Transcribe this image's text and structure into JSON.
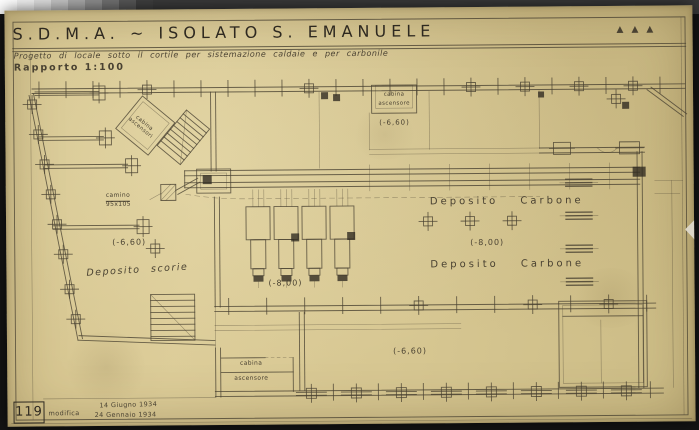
{
  "photo": {
    "background": "#141414",
    "top_strip": "#3a3a3a",
    "calibration_patches": [
      "#ffffff",
      "#f1f1f1",
      "#dedede",
      "#c4c4c4",
      "#a8a8a8",
      "#8d8d8d",
      "#717171",
      "#575757",
      "#3f3f3f"
    ]
  },
  "palette": {
    "photo-bg": "#141414",
    "strip-bg": "#3a3a3a",
    "paper": "#d8c894",
    "ink": "#4a4232",
    "ink-dark": "#2e2920"
  },
  "header": {
    "title": "S.D.M.A. ~ ISOLATO S. EMANUELE",
    "title_marks": "▲▲▲",
    "subtitle": "Progetto di locale sotto il cortile per sistemazione caldaie e per carbonile",
    "scale_label": "Rapporto 1:100"
  },
  "plan": {
    "rooms": {
      "deposito_carbone_upper": "Deposito Carbone",
      "deposito_carbone_lower": "Deposito Carbone",
      "deposito_scorie": "Deposito scorie",
      "cabina_top_line1": "cabina",
      "cabina_top_line2": "ascensore",
      "cabina_bottom_line1": "cabina",
      "cabina_bottom_line2": "ascensore",
      "cabina_tilted_line1": "cabina",
      "cabina_tilted_line2": "ascensori",
      "camino_line1": "camino",
      "camino_line2": "95x105"
    },
    "levels": {
      "upper_court": "(-6,60)",
      "scorie_area": "(-6,60)",
      "boiler_room": "(-8,00)",
      "carbone_area": "(-8,00)",
      "lower_court": "(-6,60)"
    }
  },
  "titleblock": {
    "sheet_number": "119",
    "revision_label": "modifica",
    "date_original": "14 Giugno 1934",
    "date_revision": "24 Gennaio 1934"
  }
}
